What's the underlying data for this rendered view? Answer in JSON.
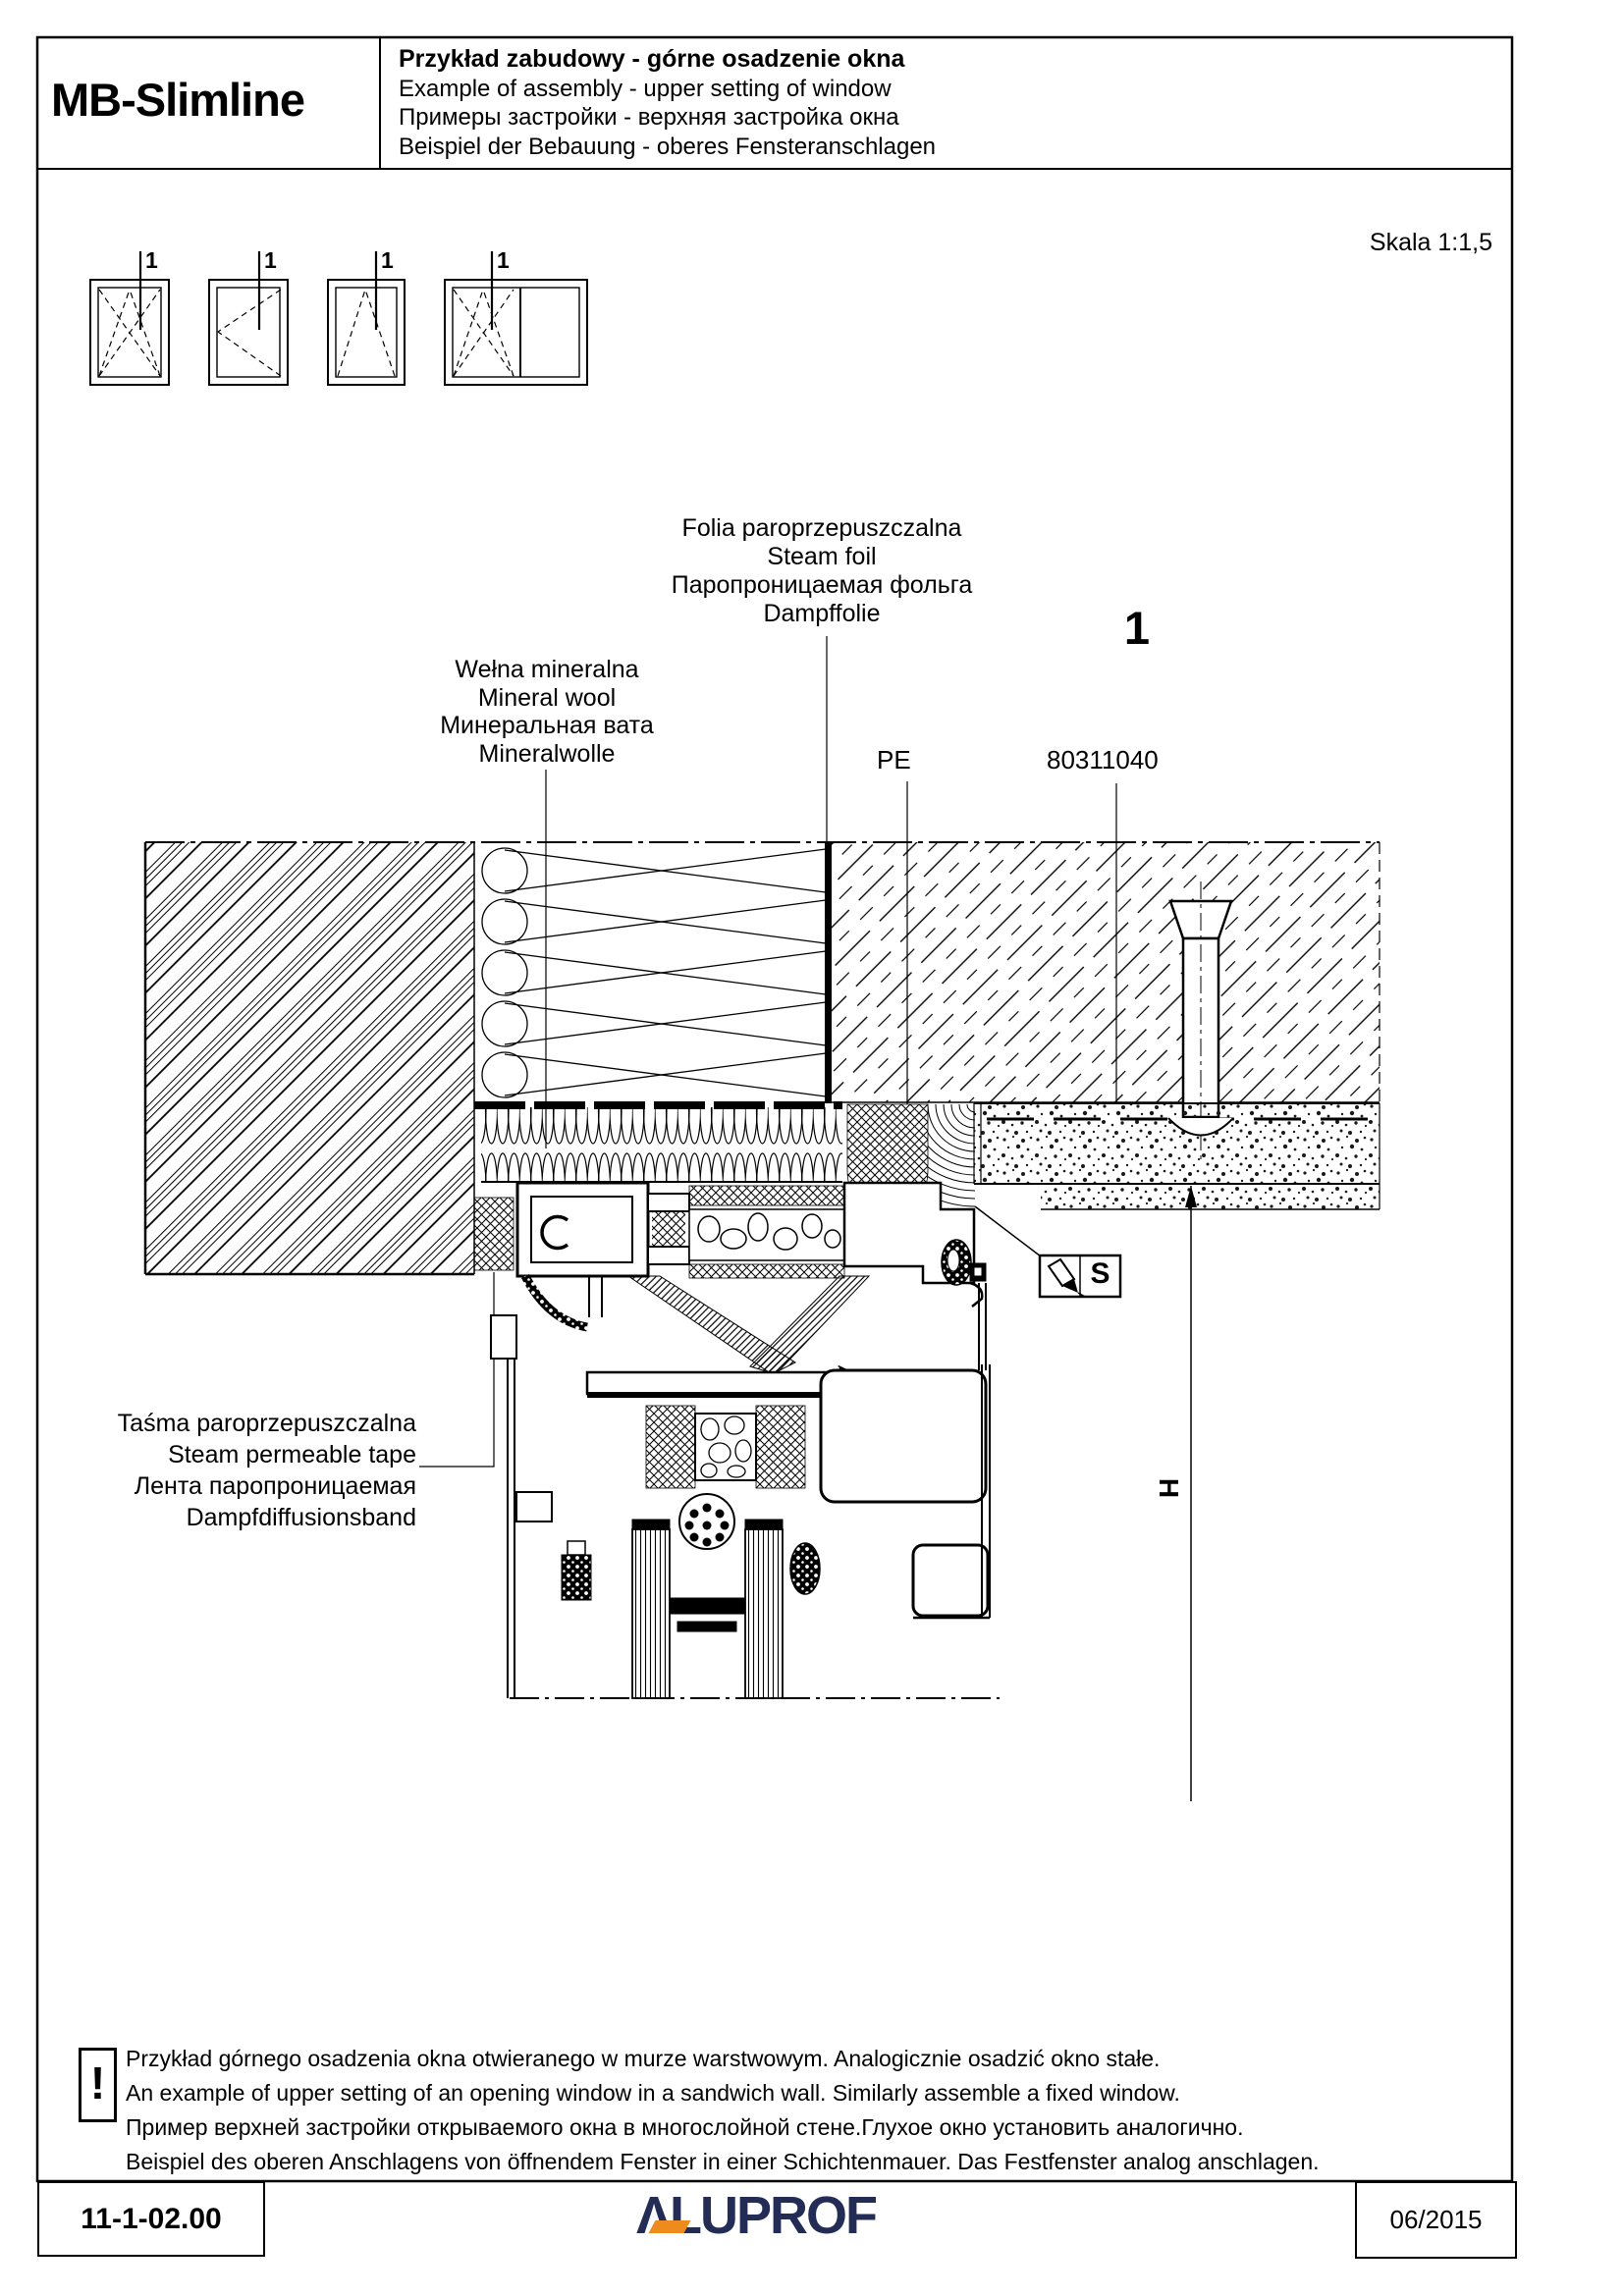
{
  "header": {
    "product": "MB-Slimline",
    "title_pl": "Przykład zabudowy - górne osadzenie okna",
    "title_en": "Example of assembly - upper setting of window",
    "title_ru": "Примеры застройки - верхняя застройка окна",
    "title_de": "Beispiel der Bebauung - oberes Fensteranschlagen",
    "scale": "Skala 1:1,5"
  },
  "symbols": {
    "marker": "1",
    "items": [
      {
        "type": "tilt-turn-window"
      },
      {
        "type": "turn-window"
      },
      {
        "type": "tilt-window"
      },
      {
        "type": "tilt-turn-with-fixed-pane-window"
      }
    ]
  },
  "labels": {
    "steam_foil": {
      "lines": [
        "Folia paroprzepuszczalna",
        "Steam foil",
        "Паропроницаемая фольга",
        "Dampffolie"
      ]
    },
    "mineral_wool": {
      "lines": [
        "Wełna mineralna",
        "Mineral wool",
        "Минеральная вата",
        "Mineralwolle"
      ]
    },
    "steam_tape": {
      "lines": [
        "Taśma paroprzepuszczalna",
        "Steam permeable tape",
        "Лента паропроницаемая",
        "Dampfdiffusionsband"
      ]
    },
    "pe": "PE",
    "part_number": "80311040",
    "detail_number": "1",
    "seal_symbol": "S",
    "height_symbol": "H"
  },
  "note": {
    "icon": "!",
    "lines": [
      "Przykład górnego osadzenia okna otwieranego w murze warstwowym. Analogicznie osadzić okno stałe.",
      "An example of upper setting of an opening window in a sandwich wall. Similarly assemble a fixed window.",
      "Пример верхней застройки открываемого окна в многослойной стене.Глухое окно установить аналогично.",
      "Beispiel des oberen Anschlagens von öffnendem Fenster in einer Schichtenmauer. Das Festfenster analog anschlagen."
    ]
  },
  "footer": {
    "doc_number": "11-1-02.00",
    "logo": "ALUPROF",
    "logo_display": "ΛLUPROF",
    "date": "06/2015"
  },
  "colors": {
    "ink": "#000000",
    "paper": "#ffffff",
    "logo_navy": "#232c55",
    "logo_orange": "#ef8b1d"
  }
}
